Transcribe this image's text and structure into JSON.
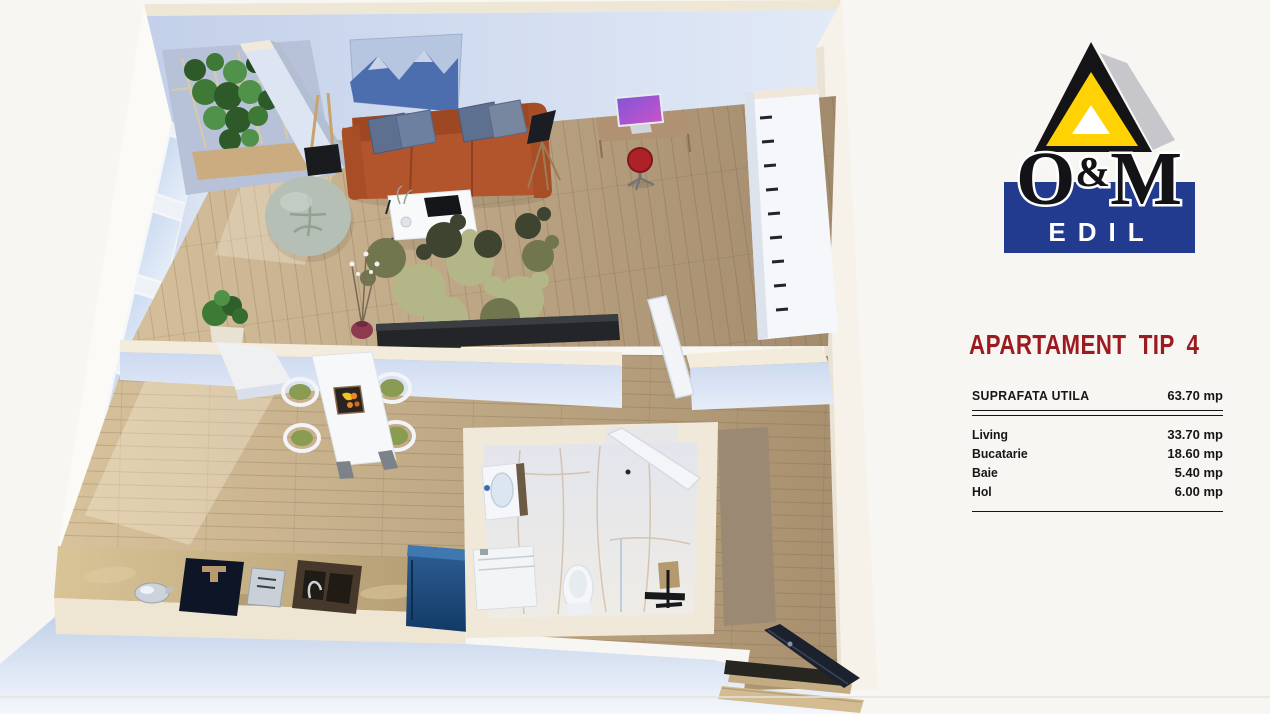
{
  "theme": {
    "bg": "#f8f6f2",
    "accent-red": "#9c1b20",
    "logo-blue": "#233b8e",
    "logo-yellow": "#ffd303",
    "logo-gray": "#c7c7cb",
    "ink": "#161616"
  },
  "logo": {
    "o": "O",
    "amp": "&",
    "m": "M",
    "edil": "EDIL"
  },
  "panel": {
    "title": "APARTAMENT TIP 4",
    "total": {
      "label": "SUPRAFATA UTILA",
      "value": "63.70 mp"
    },
    "rows": [
      {
        "label": "Living",
        "value": "33.70 mp"
      },
      {
        "label": "Bucatarie",
        "value": "18.60 mp"
      },
      {
        "label": "Baie",
        "value": "5.40 mp"
      },
      {
        "label": "Hol",
        "value": "6.00 mp"
      }
    ],
    "unit": "mp"
  },
  "floorplan": {
    "view": "3D cutaway apartment floor plan seen from above",
    "rooms": [
      {
        "name": "Living",
        "contents": [
          "terracotta sofa with blue pillows",
          "mountain wall art",
          "bean bag chair",
          "white coffee table with laptop",
          "olive puzzle rug",
          "desk with monitor",
          "red stool",
          "black floor lamp",
          "dark tv console",
          "balcony ivy planter",
          "white wardrobe",
          "flower vase"
        ]
      },
      {
        "name": "Bucatarie",
        "contents": [
          "white dining table",
          "four green chairs",
          "fruit tray",
          "stone kitchen counter",
          "dark cooktop",
          "double sink",
          "toaster",
          "kettle",
          "blue fridge"
        ]
      },
      {
        "name": "Baie",
        "contents": [
          "vanity sink",
          "washing machine",
          "toilet",
          "walk-in shower with black fixtures"
        ]
      },
      {
        "name": "Hol",
        "contents": [
          "open entry door",
          "wooden steps",
          "taupe runner"
        ]
      }
    ],
    "colors": {
      "walls": "#d5dff2",
      "wall-tops": "#f0e8d8",
      "wood-floor": "#c2ab8a",
      "marble-floor": "#e7e6e8",
      "sofa": "#b2552c",
      "counter": "#c9b388",
      "rug-olive": "#71764e",
      "fridge-blue": "#1d4c82"
    }
  }
}
